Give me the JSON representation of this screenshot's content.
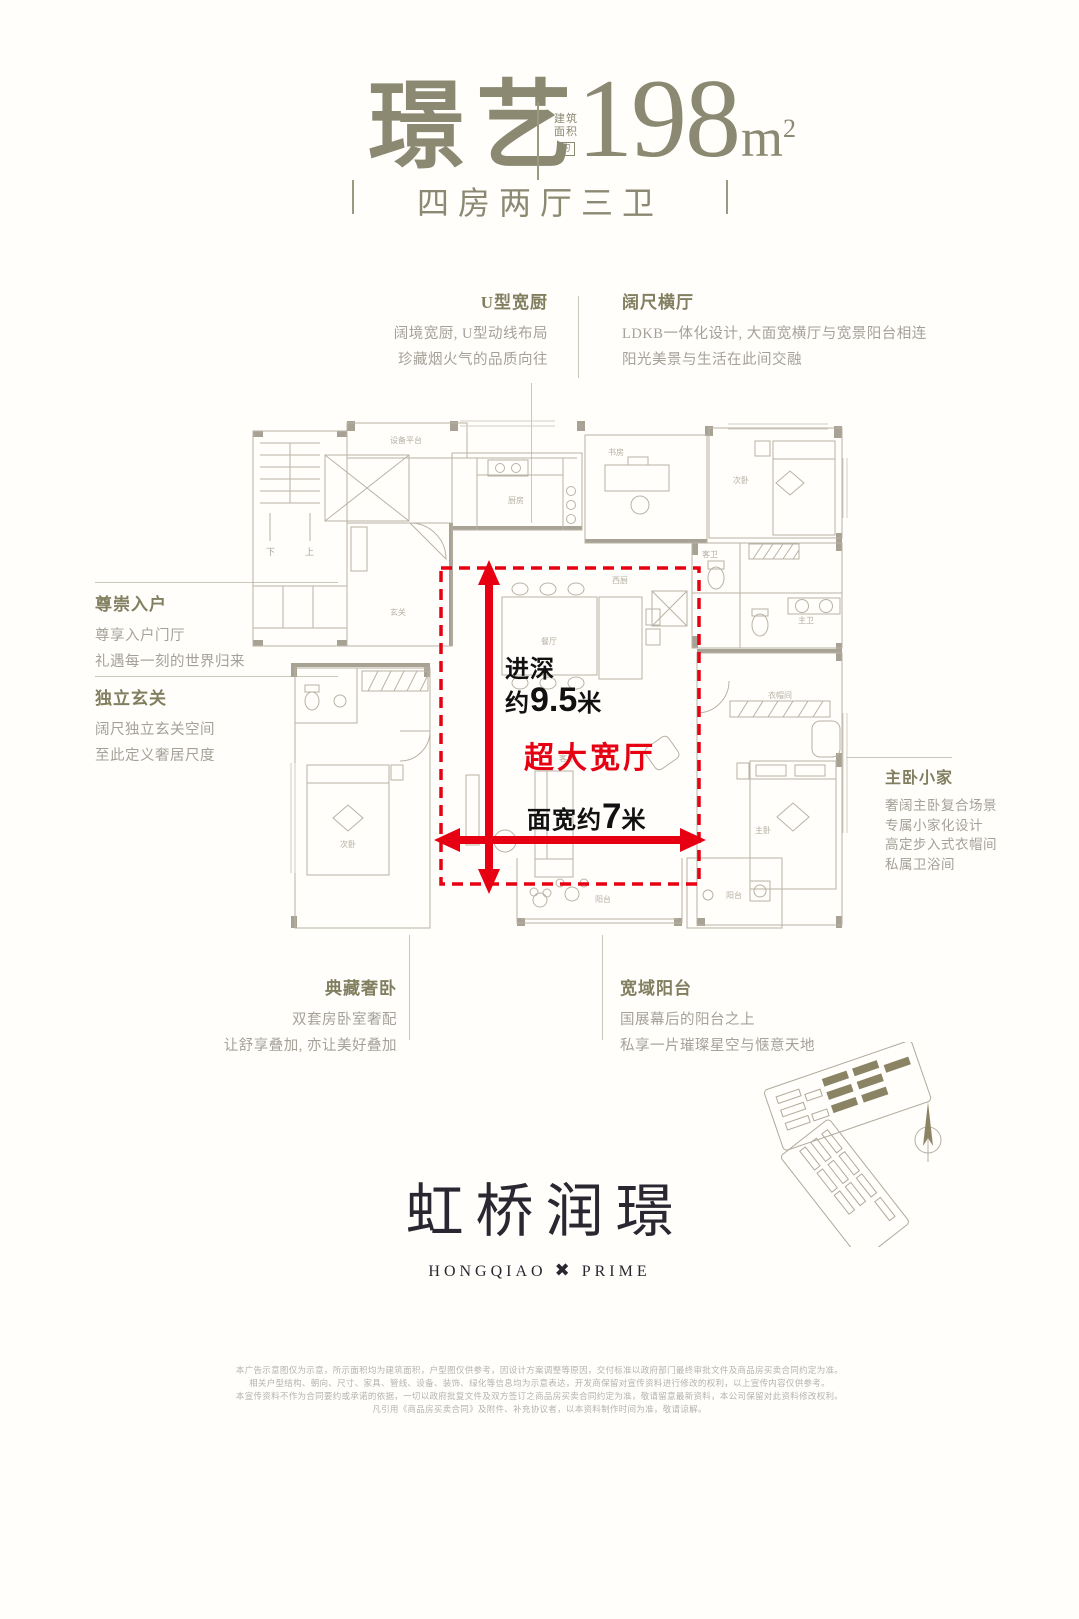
{
  "header": {
    "unit_name": "璟艺",
    "area_prefix_line1": "建筑",
    "area_prefix_line2": "面积",
    "area_approx": "约",
    "area_value": "198",
    "area_unit": "m",
    "area_sup": "2",
    "subtitle": "四房两厅三卫"
  },
  "annotations": {
    "kitchen": {
      "title": "U型宽厨",
      "line1": "阔境宽厨, U型动线布局",
      "line2": "珍藏烟火气的品质向往"
    },
    "hall": {
      "title": "阔尺横厅",
      "line1": "LDKB一体化设计, 大面宽横厅与宽景阳台相连",
      "line2": "阳光美景与生活在此间交融"
    },
    "entry": {
      "title": "尊崇入户",
      "line1": "尊享入户门厅",
      "line2": "礼遇每一刻的世界归来"
    },
    "foyer": {
      "title": "独立玄关",
      "line1": "阔尺独立玄关空间",
      "line2": "至此定义奢居尺度"
    },
    "master": {
      "title": "主卧小家",
      "line1": "奢阔主卧复合场景",
      "line2": "专属小家化设计",
      "line3": "高定步入式衣帽间",
      "line4": "私属卫浴间"
    },
    "bedroom": {
      "title": "典藏奢卧",
      "line1": "双套房卧室奢配",
      "line2": "让舒享叠加, 亦让美好叠加"
    },
    "balcony": {
      "title": "宽域阳台",
      "line1": "国展幕后的阳台之上",
      "line2": "私享一片璀璨星空与惬意天地"
    }
  },
  "measurements": {
    "depth_label": "进深",
    "depth_approx": "约",
    "depth_value": "9.5",
    "depth_unit": "米",
    "hall_label": "超大宽厅",
    "width_prefix": "面宽约",
    "width_value": "7",
    "width_unit": "米"
  },
  "plan": {
    "rooms": [
      "设备平台",
      "厨房",
      "玄关",
      "书房",
      "次卧",
      "主卫",
      "客卫",
      "衣帽间",
      "餐厅",
      "西厨",
      "客厅",
      "次卧",
      "主卧",
      "阳台",
      "阳台"
    ],
    "stair_down": "下",
    "stair_up": "上"
  },
  "logo": {
    "cn": "虹桥润璟",
    "en_left": "HONGQIAO",
    "x_symbol": "✖",
    "en_right": "PRIME"
  },
  "disclaimer": {
    "line1": "本广告示意图仅为示意，所示面积均为建筑面积，户型图仅供参考，因设计方案调整等原因，交付标准以政府部门最终审批文件及商品房买卖合同约定为准。",
    "line2": "相关户型结构、朝向、尺寸、家具、管线、设备、装饰、绿化等信息均为示意表达，开发商保留对宣传资料进行修改的权利，以上宣传内容仅供参考。",
    "line3": "本宣传资料不作为合同要约或承诺的依据，一切以政府批复文件及双方签订之商品房买卖合同约定为准，敬请留意最新资料，本公司保留对此资料修改权利。",
    "line4": "凡引用《商品房买卖合同》及附件、补充协议者，以本资料制作时间为准，敬请谅解。"
  },
  "colors": {
    "accent_red": "#e60012",
    "olive_title": "#8b8972",
    "plan_line": "#b9b3a6",
    "plan_wall": "#a8a294",
    "logo_ink": "#2a2730"
  }
}
